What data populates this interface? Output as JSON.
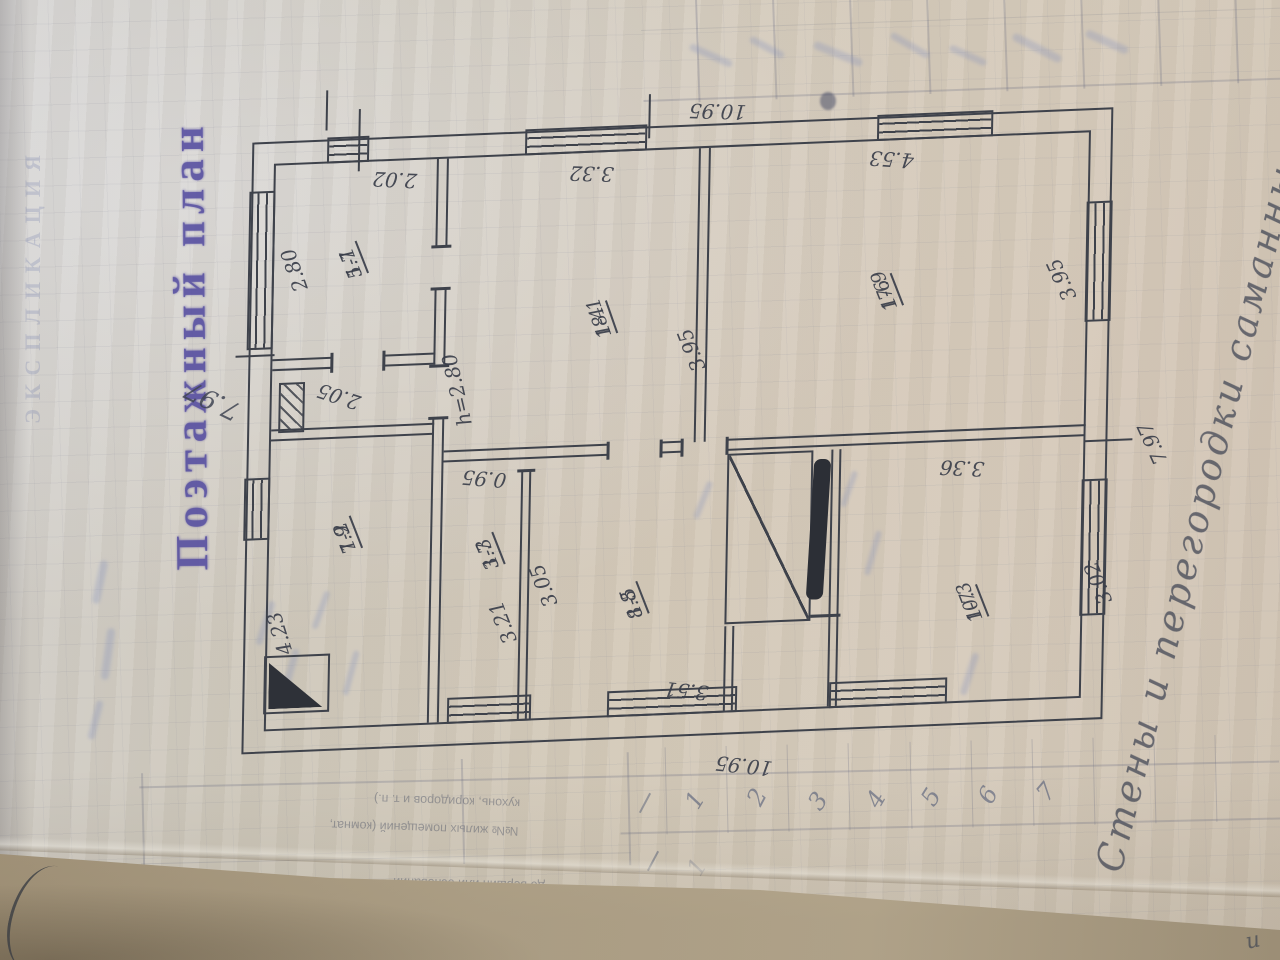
{
  "stamp_title": "Поэтажный план",
  "stamp_note": "7.97",
  "margin_note": "Стены и перегородки саманные",
  "rooms": {
    "r11": {
      "num": "1-1",
      "area": "5.7"
    },
    "r12": {
      "num": "1-2",
      "area": "7.9"
    },
    "r13": {
      "num": "1-3",
      "area": "3.7"
    },
    "r14": {
      "num": "1-4",
      "area": "18.1"
    },
    "r15": {
      "num": "1-5",
      "area": "8.8"
    },
    "r16": {
      "num": "1-6",
      "area": "17.9"
    },
    "r17": {
      "num": "1-7",
      "area": "10.3"
    }
  },
  "dims": {
    "top_overall": "10.95",
    "bottom_overall": "10.95",
    "right_overall": "7.97",
    "t202": "2.02",
    "t332": "3.32",
    "t453": "4.53",
    "room11_w": "2.80",
    "hall_w": "2.05",
    "r12_w": "4.23",
    "height_note": "h=2.80",
    "mid_395": "3.95",
    "right_395": "3.95",
    "d095": "0.95",
    "d321": "3.21",
    "d305": "3.05",
    "d351": "3.51",
    "d336": "3.36",
    "d302": "3.02"
  },
  "bleed": {
    "explication": "ЭКСПЛИКАЦИЯ",
    "table_line_1": "кухонь, коридоров и т. п.)",
    "table_line_2": "№№ жилых помещений (комнат,",
    "table_line_3": "до вершин или оснований",
    "col_numbers": [
      "1",
      "2",
      "3",
      "4",
      "5",
      "6",
      "7"
    ],
    "stray_one": "1",
    "corner_mark": "и"
  }
}
